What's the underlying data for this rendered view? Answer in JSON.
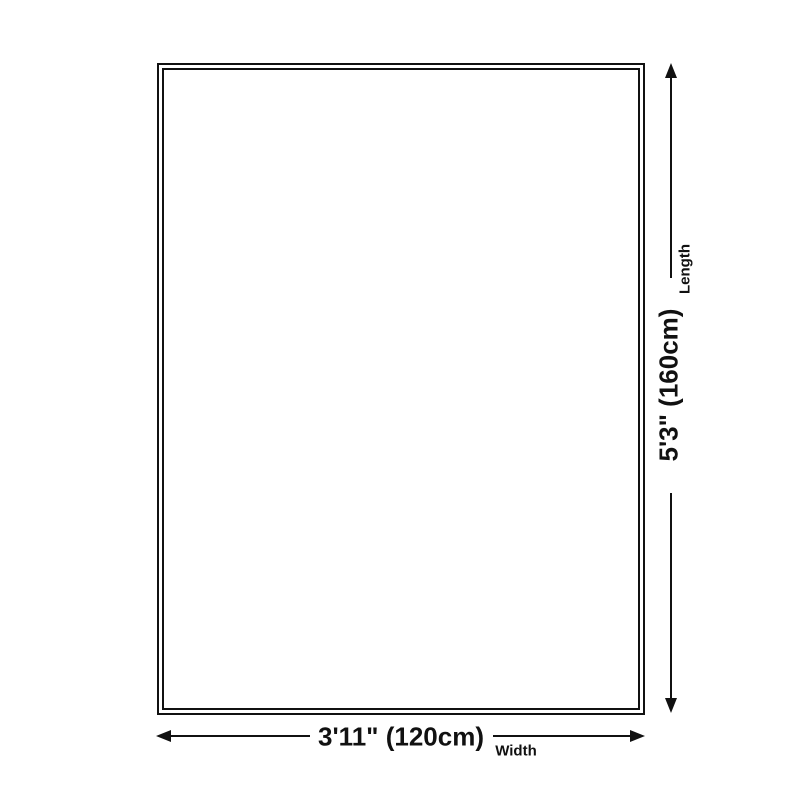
{
  "diagram": {
    "kind": "product-size-diagram",
    "background_color": "#ffffff",
    "line_color": "#111111",
    "shape": "rectangle with double border",
    "length": {
      "value": "5'3\" (160cm)",
      "label": "Length"
    },
    "width": {
      "value": "3'11\" (120cm)",
      "label": "Width"
    }
  }
}
